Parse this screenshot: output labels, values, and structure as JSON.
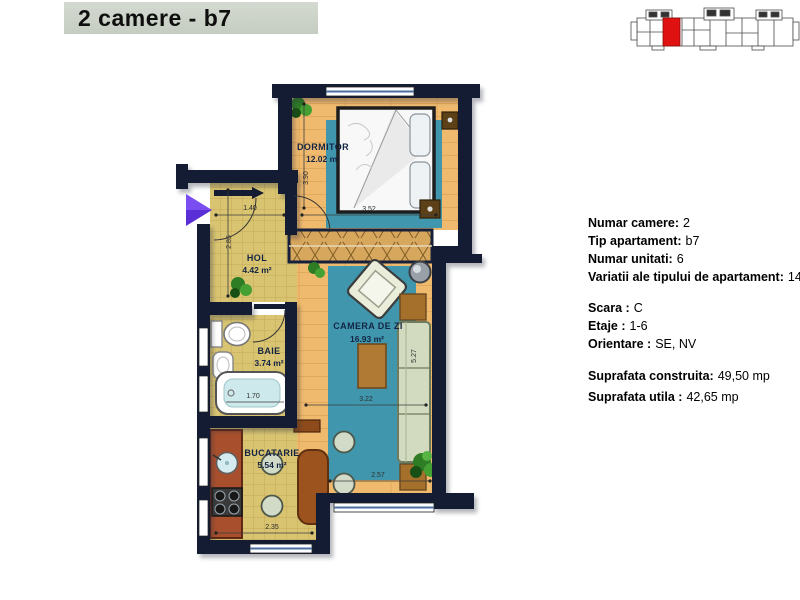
{
  "title": "2 camere - b7",
  "plan": {
    "rooms": {
      "dormitor": {
        "name": "DORMITOR",
        "area": "12.02 m²"
      },
      "hol": {
        "name": "HOL",
        "area": "4.42 m²"
      },
      "baie": {
        "name": "BAIE",
        "area": "3.74 m²"
      },
      "camera_de_zi": {
        "name": "CAMERA DE ZI",
        "area": "16.93 m²"
      },
      "bucatarie": {
        "name": "BUCATARIE",
        "area": "5.54 m²"
      }
    },
    "dims": {
      "dormitor_w": "3.52",
      "dormitor_h": "3.90",
      "hol_w": "1.40",
      "hol_h": "2.85",
      "baie_tub": "1.70",
      "living_w": "3.22",
      "living_h": "5.27",
      "living_w2": "2.57",
      "bucatarie_w": "2.35"
    }
  },
  "info": {
    "group1": [
      {
        "label": "Numar camere:",
        "value": "2"
      },
      {
        "label": "Tip apartament:",
        "value": "b7"
      },
      {
        "label": "Numar unitati:",
        "value": "6"
      },
      {
        "label": "Variatii ale tipului de apartament:",
        "value": "14"
      }
    ],
    "group2": [
      {
        "label": "Scara :",
        "value": "C"
      },
      {
        "label": "Etaje :",
        "value": "1-6"
      },
      {
        "label": "Orientare :",
        "value": "SE, NV"
      }
    ],
    "group3": [
      {
        "label": "Suprafata construita:",
        "value": "49,50 mp"
      },
      {
        "label": "Suprafata utila :",
        "value": "42,65 mp"
      }
    ]
  },
  "colors": {
    "highlight_red": "#e01111",
    "entrance_arrow": "#5b2fd6",
    "wall": "#141c33",
    "rug_teal": "#4097ad"
  }
}
